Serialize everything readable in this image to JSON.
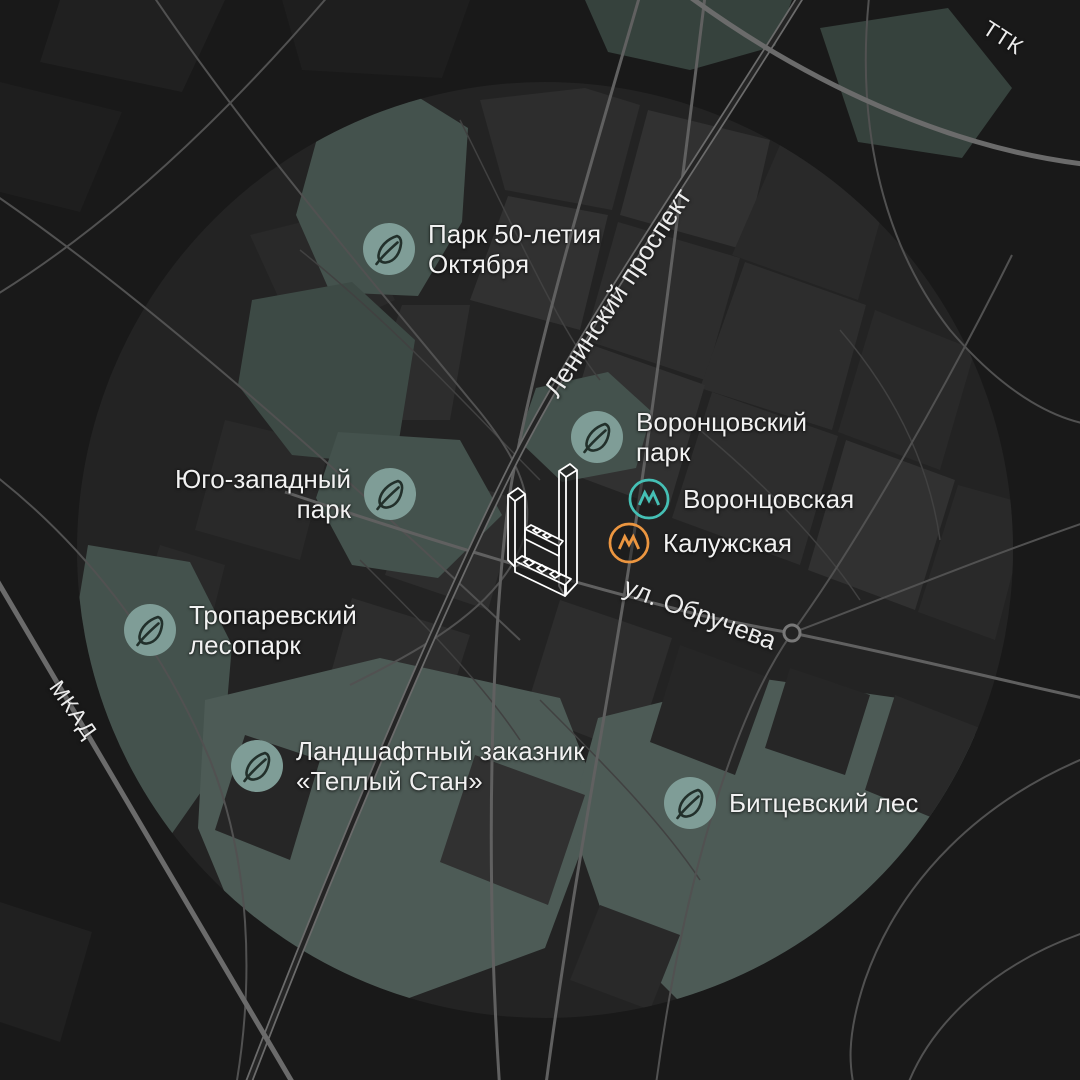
{
  "palette": {
    "background": "#191919",
    "city_area": "#232323",
    "block": "#2d2d2d",
    "park_fill": "#44524d",
    "park_icon_bg": "#7f9d97",
    "leaf_stroke": "#22302b",
    "road": "#6b6b6b",
    "road_minor": "#515151",
    "label_text": "#f1f1f1",
    "metro_teal": "#45c0b5",
    "metro_orange": "#ec9640",
    "building_outline": "#ffffff"
  },
  "parks": {
    "items": [
      {
        "id": "park-50-letiya",
        "label_line1": "Парк 50-летия",
        "label_line2": "Октября"
      },
      {
        "id": "vorontsovsky",
        "label_line1": "Воронцовский",
        "label_line2": "парк"
      },
      {
        "id": "yugo-zapadny",
        "label_line1": "Юго-западный",
        "label_line2": "парк"
      },
      {
        "id": "troparevsky",
        "label_line1": "Тропаревский",
        "label_line2": "лесопарк"
      },
      {
        "id": "teply-stan",
        "label_line1": "Ландшафтный заказник",
        "label_line2": "«Теплый Стан»"
      },
      {
        "id": "bitsevsky",
        "label_line1": "Битцевский лес",
        "label_line2": ""
      }
    ]
  },
  "metro": {
    "items": [
      {
        "id": "vorontsovskaya",
        "label": "Воронцовская",
        "line_color": "#45c0b5"
      },
      {
        "id": "kaluzhskaya",
        "label": "Калужская",
        "line_color": "#ec9640"
      }
    ]
  },
  "roads": {
    "labels": [
      {
        "id": "ttk",
        "label": "ТТК"
      },
      {
        "id": "mkad",
        "label": "МКАД"
      },
      {
        "id": "leninsky",
        "label": "Ленинский проспект"
      },
      {
        "id": "obrucheva",
        "label": "ул. Обручева"
      }
    ]
  }
}
